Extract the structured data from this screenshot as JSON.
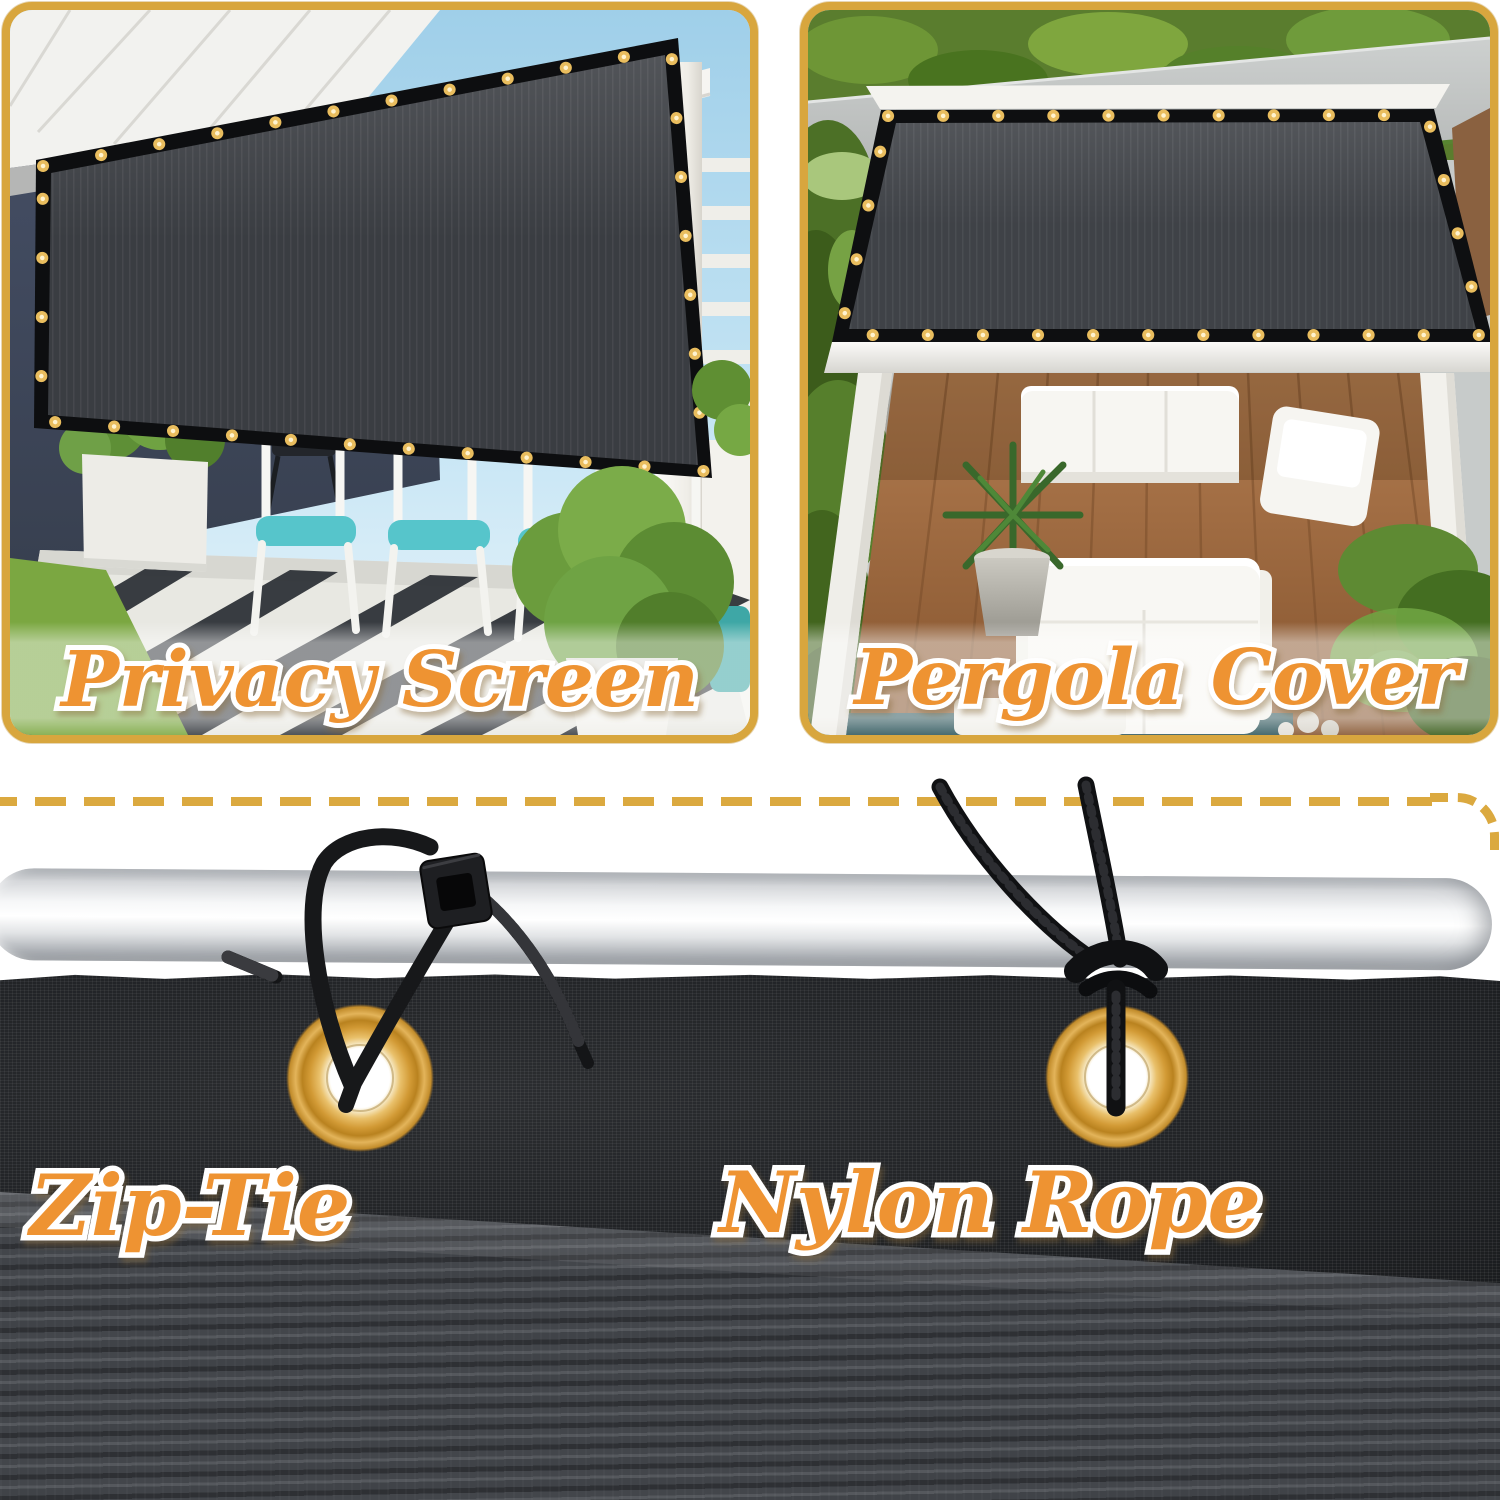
{
  "product_collage": {
    "top_panels": [
      {
        "id": "privacy-screen",
        "label": "Privacy Screen"
      },
      {
        "id": "pergola-cover",
        "label": "Pergola Cover"
      }
    ],
    "bottom_features": [
      {
        "id": "zip-tie",
        "label": "Zip-Tie"
      },
      {
        "id": "nylon-rope",
        "label": "Nylon Rope"
      }
    ],
    "colors": {
      "frame_gold": "#D8A63E",
      "dash_gold": "#DBA93F",
      "label_orange": "#EE9333",
      "label_outline": "#FFFFFF",
      "grommet_brass": "#D9A23C",
      "shade_fabric_dark": "#3A3D42"
    }
  }
}
